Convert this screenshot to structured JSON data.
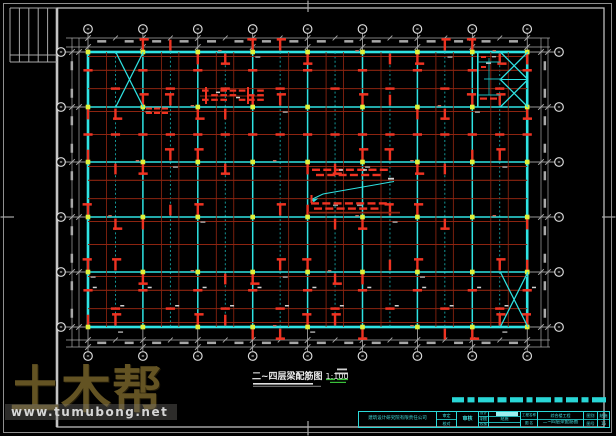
{
  "document": {
    "kind": "structural CAD floor-plan screenshot",
    "background": "#000000"
  },
  "watermark": {
    "logo": "土木帮",
    "url": "www.tumubong.net",
    "logo_color": "#6b5a26",
    "url_color": "#d6d6d6"
  },
  "drawing_title": {
    "text": "二~四层梁配筋图",
    "scale": "1:100",
    "color": "#ececec"
  },
  "title_block": {
    "company": "建筑设计研究院有限责任公司",
    "check1": "审定",
    "check2": "校对",
    "stamp": "审核",
    "sec_labels": [
      "设计",
      "制图",
      "校核"
    ],
    "sec_mid": "结施",
    "label_project": "工程名称",
    "label_name": "图  名",
    "project": "综合楼工程",
    "drawing_name": "二~四层梁配筋图",
    "g_r1l": "图别",
    "g_r1r": "结施",
    "g_r2l": "图号",
    "g_r2r": "15"
  },
  "plan": {
    "origin_x": 88,
    "origin_y": 52,
    "axes_x": 9,
    "axes_y": 6,
    "bay_w": 54.9,
    "bay_h": 55,
    "colors": {
      "cyanMain": "#2fe3e3",
      "cyanSec": "#18bcbc",
      "red1": "#ee3322",
      "red2": "#8c2410",
      "yellow": "#dff03a",
      "dim": "#a8a8a8",
      "frame": "#9a9a9a",
      "white": "#d0d0d0"
    },
    "x_braces": [
      {
        "x1": 115.7,
        "y1": 52,
        "x2": 143.3,
        "y2": 107,
        "double": false
      },
      {
        "x1": 500.3,
        "y1": 52,
        "x2": 527.9,
        "y2": 107,
        "double": true
      },
      {
        "x1": 500.3,
        "y1": 272,
        "x2": 527.9,
        "y2": 327,
        "double": false
      }
    ]
  }
}
